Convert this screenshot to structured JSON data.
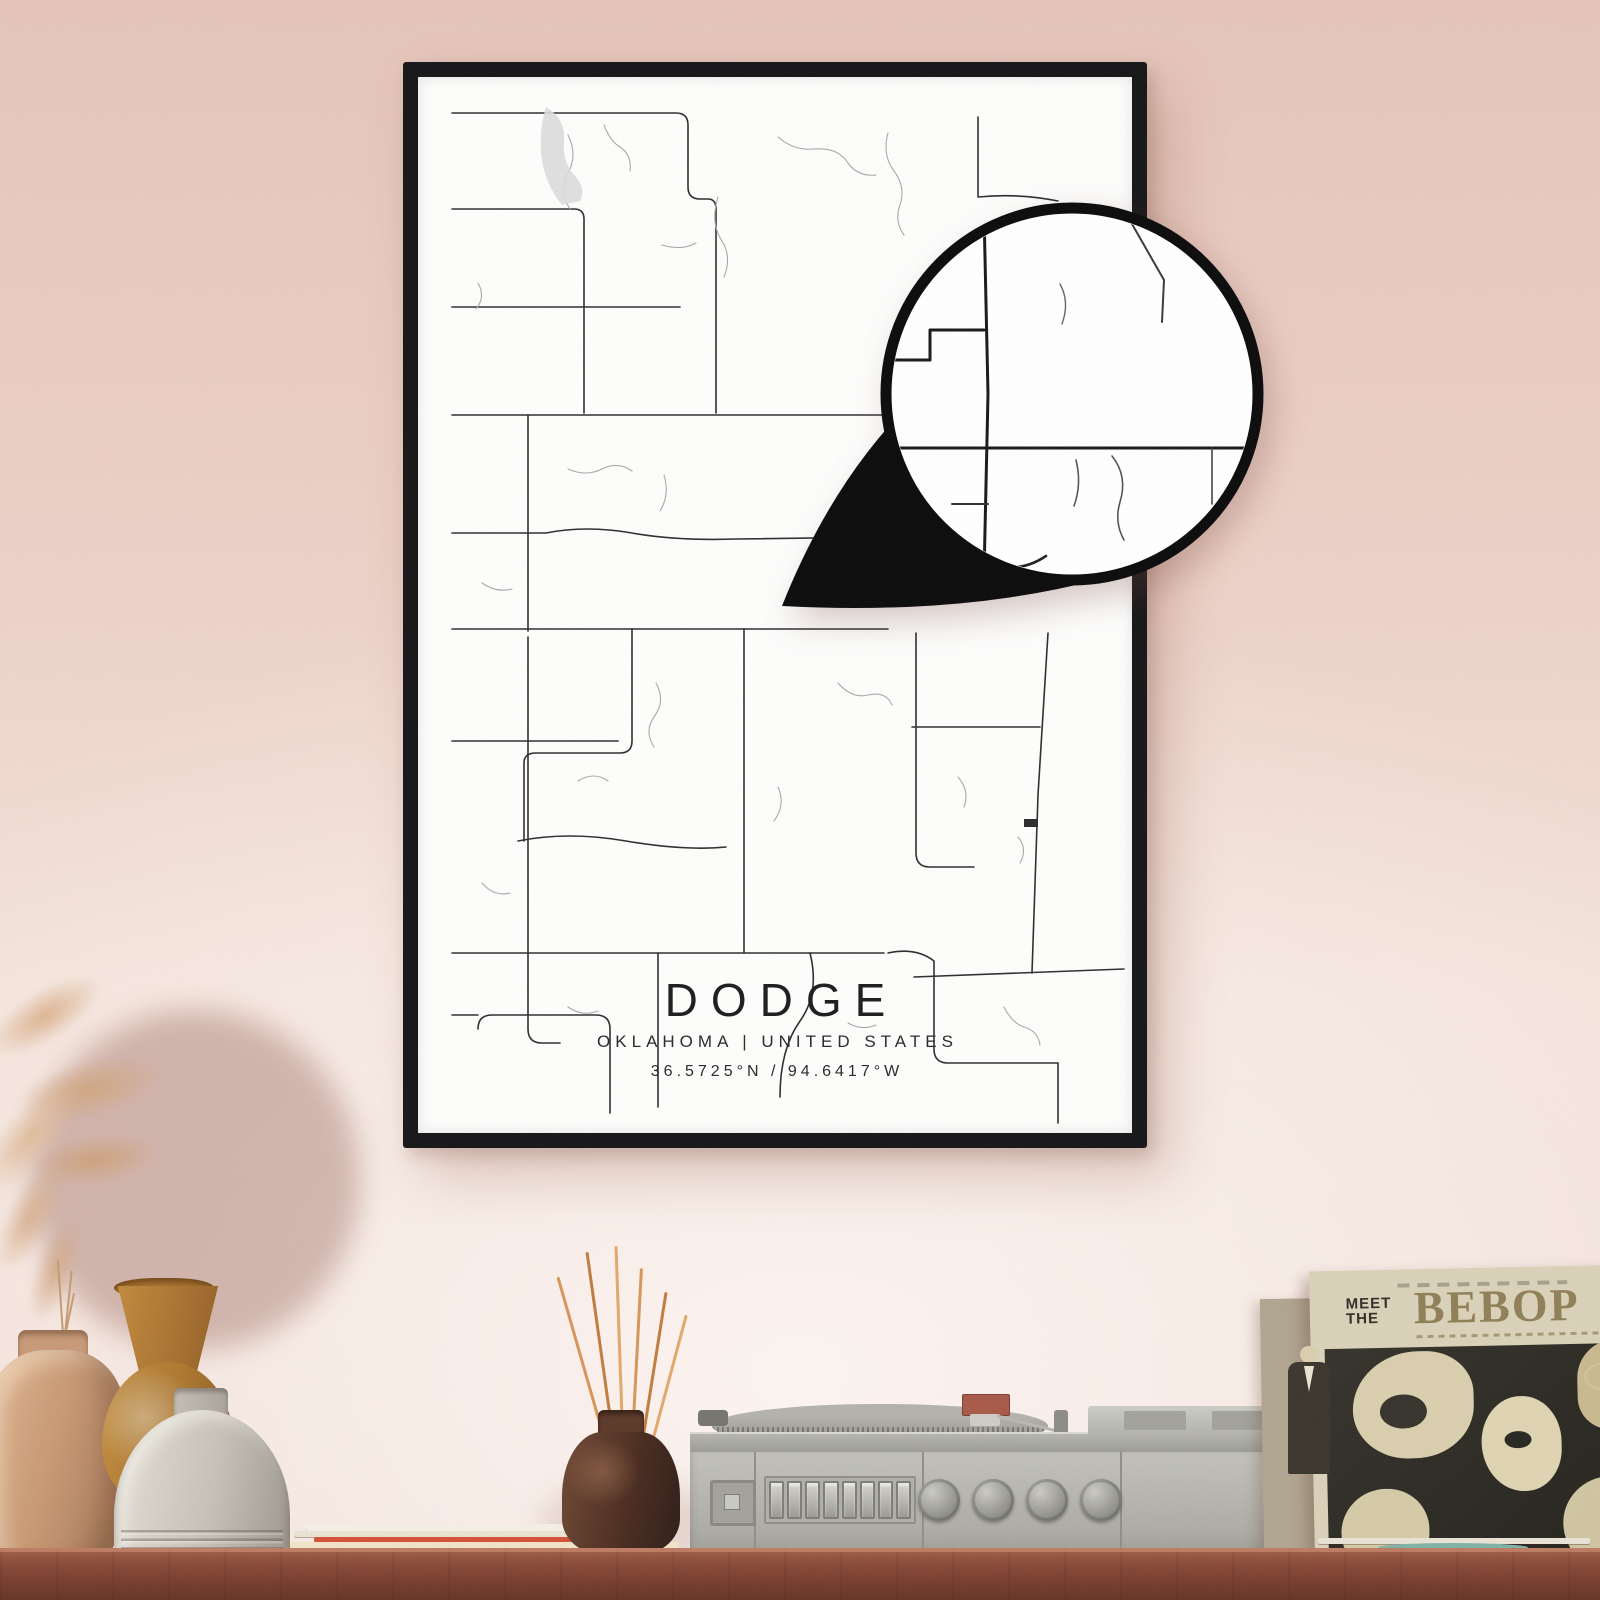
{
  "poster": {
    "title": "DODGE",
    "subtitle": "OKLAHOMA | UNITED STATES",
    "coordinates": "36.5725°N / 94.6417°W",
    "frame_color": "#17171a",
    "paper_color": "#fdfdfc",
    "road_color": "#2f2f2f",
    "minor_road_color": "#a9a9a9",
    "water_color": "#dcdcdc"
  },
  "magnifier": {
    "ring_color": "#0c0c0c",
    "fill_color": "#ffffff"
  },
  "wall": {
    "color_top": "#e5c5ba",
    "color_bottom": "#f3e1d9"
  },
  "shelf": {
    "wood_color": "#8a4b38"
  },
  "record_sleeve": {
    "title_line1": "MEET",
    "title_line2": "THE",
    "title_line3": "BEBOP",
    "accent_color": "#8f8058",
    "photo_bg": "#2e2c25"
  },
  "record_player": {
    "body_color": "#b9b8b2",
    "base_color": "#4a4945",
    "cartridge_color": "#a85a49"
  }
}
